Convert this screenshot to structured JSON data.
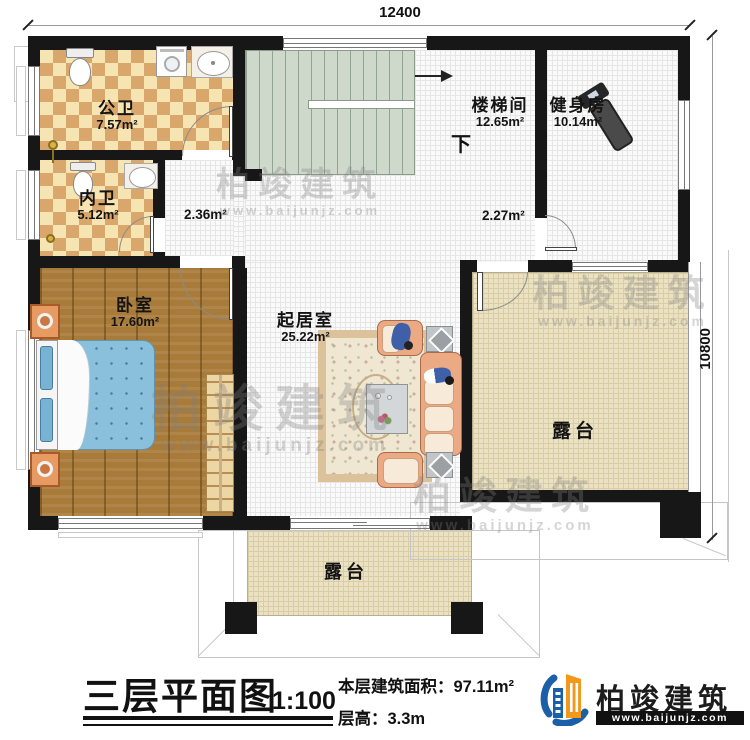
{
  "title_block": {
    "plan_title": "三层平面图",
    "scale": "1:100",
    "area_line": "本层建筑面积：97.11m²",
    "height_line": "层高：3.3m"
  },
  "dimensions": {
    "top_width": "12400",
    "right_height": "10800"
  },
  "rooms": [
    {
      "name": "公卫",
      "area": "7.57m²"
    },
    {
      "name": "内卫",
      "area": "5.12m²"
    },
    {
      "name": "卧室",
      "area": "17.60m²"
    },
    {
      "name": "起居室",
      "area": "25.22m²"
    },
    {
      "name": "楼梯间",
      "area": "12.65m²"
    },
    {
      "name": "健身房",
      "area": "10.14m²"
    },
    {
      "name": "露台",
      "area": ""
    },
    {
      "name": "露台",
      "area": ""
    }
  ],
  "annotations": {
    "hall_area_1": "2.36m²",
    "hall_area_2": "2.27m²",
    "stair_direction": "下"
  },
  "brand": {
    "company": "柏竣建筑",
    "website": "www.baijunjz.com"
  },
  "watermark": {
    "text": "柏竣建筑",
    "url": "www.baijunjz.com"
  },
  "colors": {
    "wall": "#171717",
    "bath_dark": "#d9a76b",
    "bath_light": "#f6e4b3",
    "wood": "#a87b3a",
    "stair": "#ced8cb",
    "terrace": "#ebe2c3",
    "bed": "#8ac0dc",
    "sofa": "#eba984",
    "logo_blue": "#1a5fa8",
    "logo_orange": "#f2991d"
  }
}
